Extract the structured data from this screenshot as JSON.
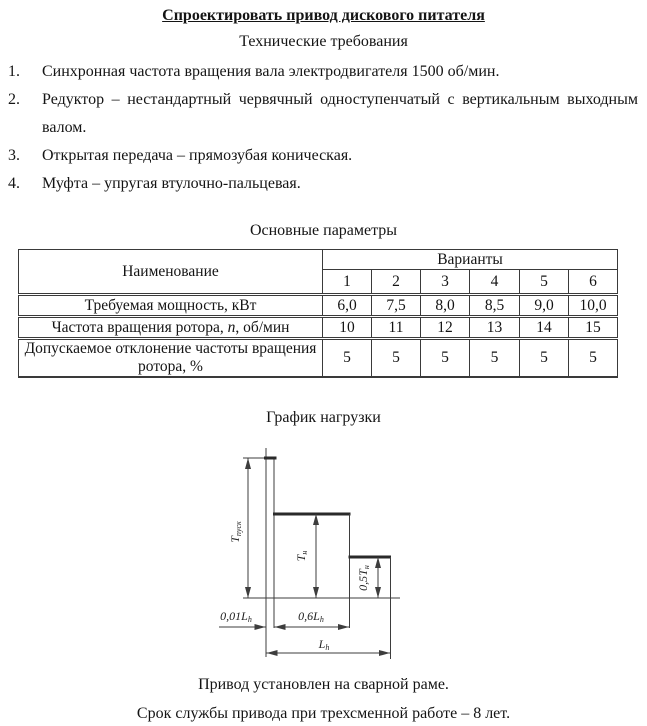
{
  "doc": {
    "title": "Спроектировать привод дискового питателя",
    "subtitle": "Технические требования"
  },
  "requirements": [
    {
      "num": "1.",
      "text": "Синхронная частота вращения вала электродвигателя 1500 об/мин."
    },
    {
      "num": "2.",
      "text": "Редуктор – нестандартный червячный одноступенчатый с вертикальным выходным валом."
    },
    {
      "num": "3.",
      "text": "Открытая передача – прямозубая коническая."
    },
    {
      "num": "4.",
      "text": "Муфта – упругая втулочно-пальцевая."
    }
  ],
  "table": {
    "caption": "Основные параметры",
    "name_header": "Наименование",
    "variants_header": "Варианты",
    "variant_numbers": [
      "1",
      "2",
      "3",
      "4",
      "5",
      "6"
    ],
    "rows": [
      {
        "label": "Требуемая мощность, кВт",
        "values": [
          "6,0",
          "7,5",
          "8,0",
          "8,5",
          "9,0",
          "10,0"
        ]
      },
      {
        "label_prefix": "Частота вращения ротора, ",
        "label_symbol": "n",
        "label_suffix": ", об/мин",
        "values": [
          "10",
          "11",
          "12",
          "13",
          "14",
          "15"
        ]
      },
      {
        "label": "Допускаемое отклонение частоты вращения ротора, %",
        "values": [
          "5",
          "5",
          "5",
          "5",
          "5",
          "5"
        ]
      }
    ]
  },
  "graph": {
    "caption": "График нагрузки",
    "labels": {
      "t_start_main": "T",
      "t_start_sub": "пуск",
      "t_nom_main": "T",
      "t_nom_sub": "н",
      "t_half_main": "0,5T",
      "t_half_sub": "н",
      "x_start_main": "0,01L",
      "x_start_sub": "h",
      "x_mid_main": "0,6L",
      "x_mid_sub": "h",
      "x_total_main": "L",
      "x_total_sub": "h"
    }
  },
  "footer": {
    "line1": "Привод установлен на сварной раме.",
    "line2": "Срок службы привода при трехсменной работе – 8 лет."
  }
}
